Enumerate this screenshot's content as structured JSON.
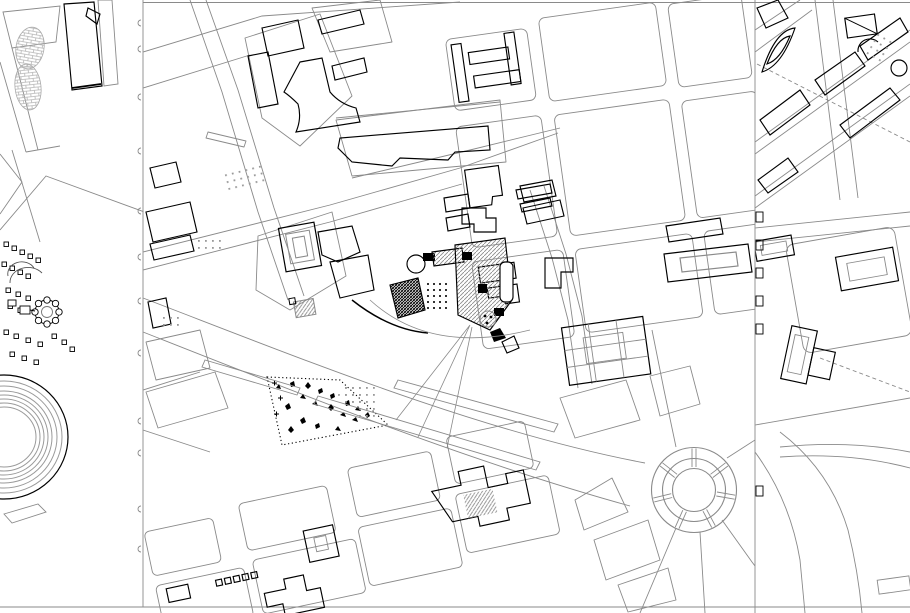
{
  "canvas": {
    "width": 910,
    "height": 613,
    "background": "#ffffff"
  },
  "colors": {
    "background": "#ffffff",
    "street": "#8a8a8a",
    "building": "#000000",
    "hatch": "#b5b5b5",
    "grayhatch": "#8d8d8d",
    "stipple": "#999999",
    "dashed": "#8a8a8a",
    "divider": "#8a8a8a"
  },
  "panels": [
    {
      "id": "left-sheet",
      "features": [
        "hatched-footprint-mound",
        "corner-buildings",
        "rotunda-ensemble",
        "amphitheater-rings",
        "plinth-parallelogram"
      ]
    },
    {
      "id": "center-sheet",
      "features": [
        "street-grid",
        "tri-lobe-tower",
        "monument-complex",
        "courtyard-palace",
        "tree-garden",
        "boulevard-medians",
        "circular-plaza-roundabout",
        "stepped-buildings",
        "courtyard-block"
      ]
    },
    {
      "id": "right-sheet",
      "features": [
        "diagonal-avenues",
        "dashed-survey-line",
        "leaf-shaped-plots",
        "courtyard-buildings",
        "park-curves"
      ]
    }
  ]
}
